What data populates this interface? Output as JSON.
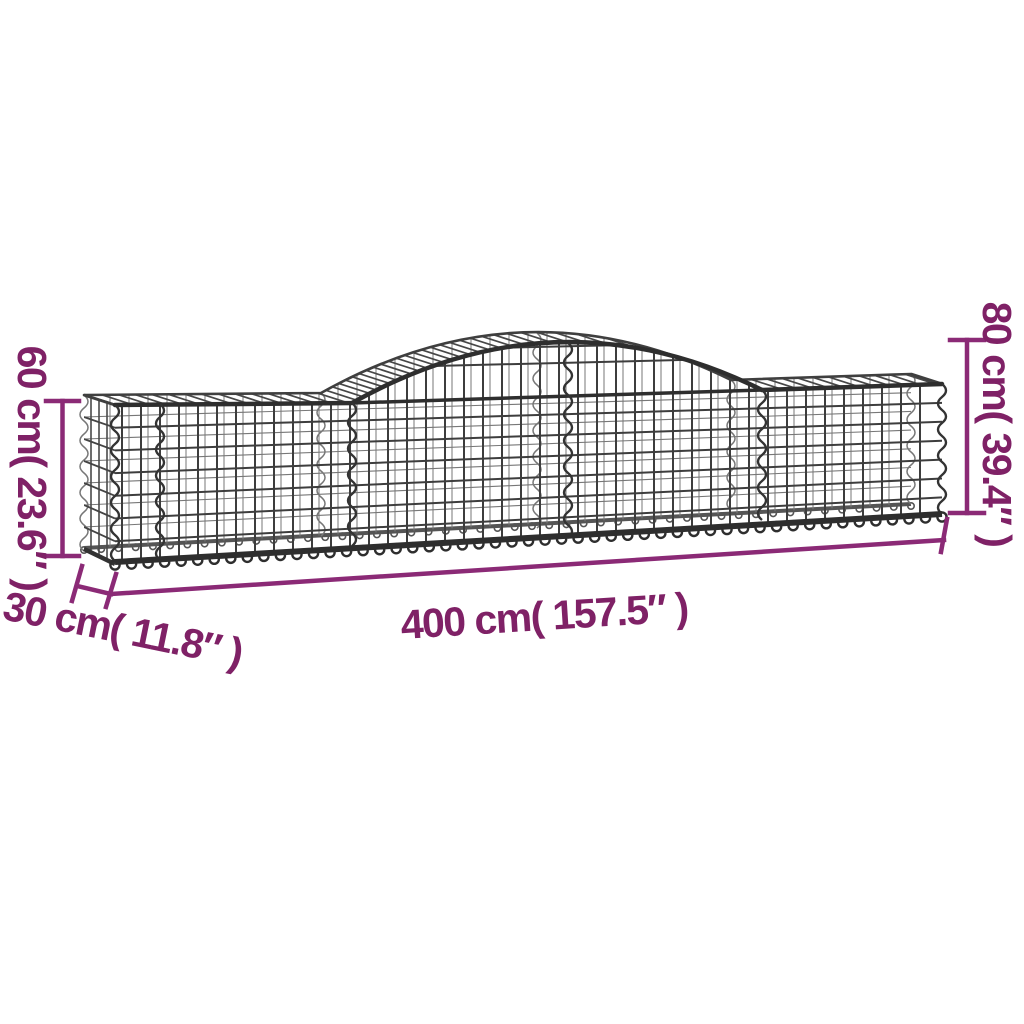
{
  "labels": {
    "height_left": "60 cm( 23.6″ )",
    "height_right": "80 cm( 39.4″ )",
    "depth": "30 cm( 11.8″ )",
    "width": "400 cm( 157.5″ )"
  },
  "colors": {
    "dimension_line": "#8b2a76",
    "dimension_text": "#7f2166",
    "wire_dark": "#2e2e2e",
    "wire_mid": "#3d3d3d",
    "wire_light": "#777777",
    "background": "#ffffff"
  }
}
